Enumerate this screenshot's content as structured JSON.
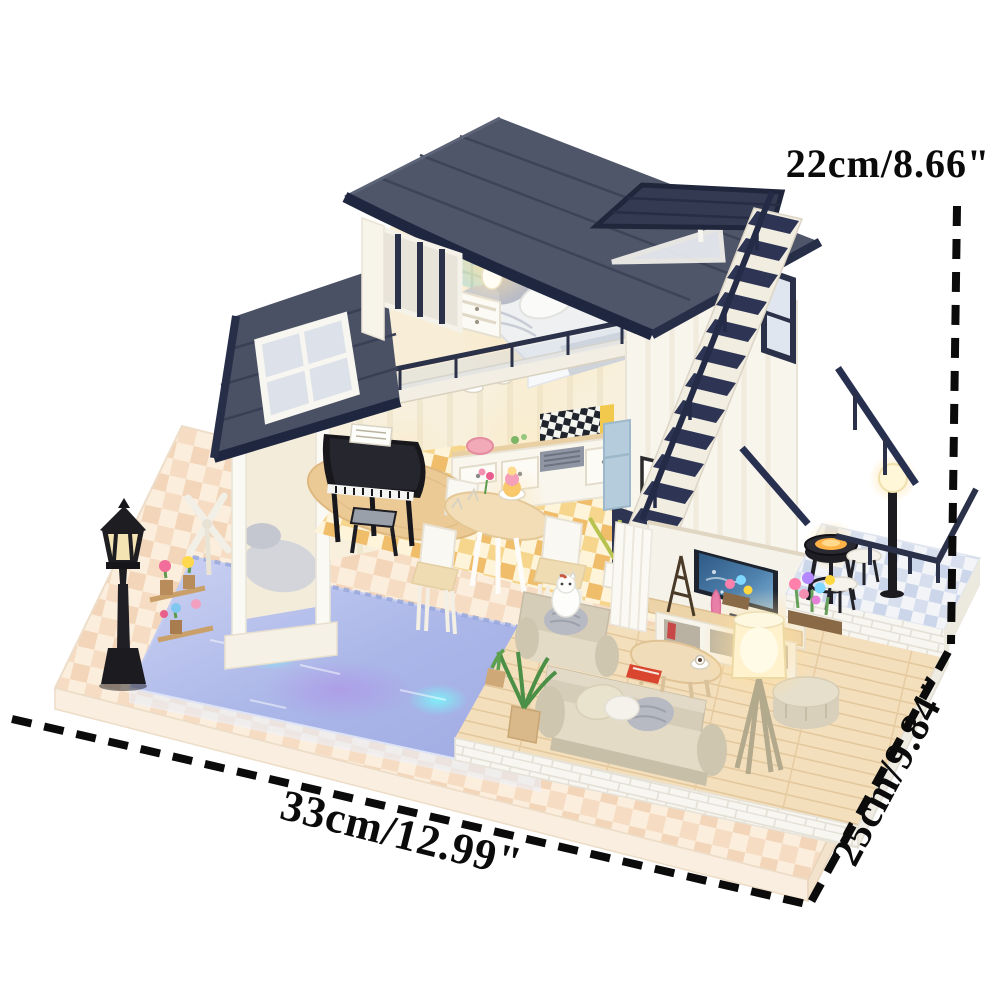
{
  "meta": {
    "image_kind": "product photo",
    "subject": "DIY miniature dollhouse kit — two-story loft villa with LED swimming pool, furniture and warm lights, annotated with outer dimensions",
    "background": "#ffffff"
  },
  "annotations": {
    "height": {
      "label": "22cm/8.66\"",
      "position": "top-right",
      "line": "vertical dashed"
    },
    "depth": {
      "label": "25cm/9.84\"",
      "position": "right-bottom",
      "line": "diagonal dashed"
    },
    "width": {
      "label": "33cm/12.99\"",
      "position": "bottom-left",
      "line": "diagonal dashed"
    }
  },
  "palette": {
    "annotation_black": "#0b0b0b",
    "roof_navy": "#272e48",
    "roof_slate": "#4d5468",
    "wall_white": "#f8f5ed",
    "wood_light": "#f3ddb9",
    "base_peach": "#f6dcc3",
    "pool_blue": "#aab6e8",
    "led_cyan": "#7df0f8",
    "led_purple": "#b47ae8",
    "glow_warm": "#ffe9a8",
    "tv_screen_blue": "#2e5985"
  },
  "scene": {
    "objects": [
      "curved navy plank roof",
      "rooftop pop-up skylight deck",
      "loft bedroom with bed, pillows and glowing bedside lamp",
      "blue tiled bathroom with vanity",
      "long navy staircase",
      "loft balcony glass railing",
      "black grand piano with stool",
      "kitchen with black-white checkered backsplash and blue fridge",
      "round dining table with cake stand and white chairs",
      "wall picture frame",
      "TV wall with aquarium screen, Eiffel tower figurine and media console",
      "beige sofa, armchair with white cat, coffee table, ottoman, glowing drum floor lamp",
      "outdoor deck with barbecue grill, stools, globe lamp and navy railings",
      "LED swimming pool with acrylic rim",
      "poolside cabana with cushion",
      "flower shelf",
      "windmill decor",
      "black street lamp",
      "checkered peach display base"
    ]
  }
}
